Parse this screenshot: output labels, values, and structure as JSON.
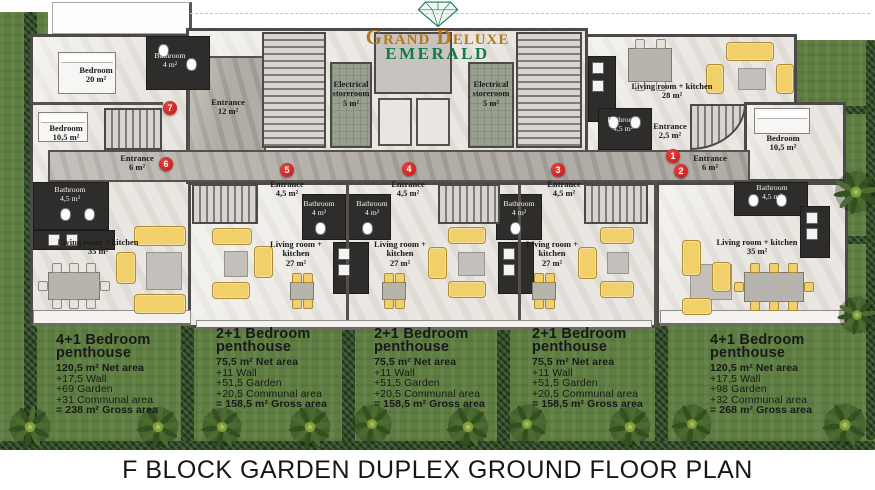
{
  "logo": {
    "brand": "Grand Deluxe",
    "sub": "EMERALD",
    "brand_color": "#b5781d",
    "sub_color": "#157a46",
    "diamond_icon_color": "#1c7c4e"
  },
  "plan_title": "F BLOCK GARDEN DUPLEX GROUND FLOOR PLAN",
  "colors": {
    "grass": "#5e7e41",
    "hedge": "#2b4621",
    "marker": "#c11717",
    "furniture": "#f1d06c",
    "walls": "#4c4a48"
  },
  "markers": [
    {
      "n": "1",
      "x": 673,
      "y": 156
    },
    {
      "n": "2",
      "x": 681,
      "y": 171
    },
    {
      "n": "3",
      "x": 558,
      "y": 170
    },
    {
      "n": "4",
      "x": 409,
      "y": 169
    },
    {
      "n": "5",
      "x": 287,
      "y": 170
    },
    {
      "n": "6",
      "x": 166,
      "y": 164
    },
    {
      "n": "7",
      "x": 170,
      "y": 108
    }
  ],
  "room_labels": [
    {
      "lines": [
        "Bedroom",
        "20 m²"
      ],
      "x": 96,
      "y": 66,
      "dark": false
    },
    {
      "lines": [
        "Bathroom",
        "4 m²"
      ],
      "x": 170,
      "y": 52,
      "dark": true
    },
    {
      "lines": [
        "Bedroom",
        "10,5 m²"
      ],
      "x": 66,
      "y": 124,
      "dark": false
    },
    {
      "lines": [
        "Entrance",
        "6 m²"
      ],
      "x": 137,
      "y": 154,
      "dark": false
    },
    {
      "lines": [
        "Entrance",
        "12 m²"
      ],
      "x": 228,
      "y": 98,
      "dark": false
    },
    {
      "lines": [
        "Electrical",
        "storeroom",
        "5 m²"
      ],
      "x": 351,
      "y": 80,
      "dark": false
    },
    {
      "lines": [
        "Electrical",
        "storeroom",
        "5 m²"
      ],
      "x": 491,
      "y": 80,
      "dark": false
    },
    {
      "lines": [
        "Living room +  kitchen",
        "28 m²"
      ],
      "x": 672,
      "y": 82,
      "dark": false
    },
    {
      "lines": [
        "Bathroom",
        "4,5 m²"
      ],
      "x": 623,
      "y": 116,
      "dark": true
    },
    {
      "lines": [
        "Entrance",
        "2,5 m²"
      ],
      "x": 670,
      "y": 122,
      "dark": false
    },
    {
      "lines": [
        "Entrance",
        "6 m²"
      ],
      "x": 710,
      "y": 154,
      "dark": false
    },
    {
      "lines": [
        "Bedroom",
        "10,5 m²"
      ],
      "x": 783,
      "y": 134,
      "dark": false
    },
    {
      "lines": [
        "Bathroom",
        "4,5 m²"
      ],
      "x": 70,
      "y": 186,
      "dark": true
    },
    {
      "lines": [
        "Living room +  kitchen",
        "35 m²"
      ],
      "x": 98,
      "y": 238,
      "dark": false
    },
    {
      "lines": [
        "Entrance",
        "4,5 m²"
      ],
      "x": 287,
      "y": 180,
      "dark": false
    },
    {
      "lines": [
        "Bathroom",
        "4 m²"
      ],
      "x": 319,
      "y": 200,
      "dark": true
    },
    {
      "lines": [
        "Bathroom",
        "4 m²"
      ],
      "x": 372,
      "y": 200,
      "dark": true
    },
    {
      "lines": [
        "Living room +",
        "kitchen",
        "27 m²"
      ],
      "x": 296,
      "y": 240,
      "dark": false
    },
    {
      "lines": [
        "Entrance",
        "4,5 m²"
      ],
      "x": 408,
      "y": 180,
      "dark": false
    },
    {
      "lines": [
        "Living room +",
        "kitchen",
        "27 m²"
      ],
      "x": 400,
      "y": 240,
      "dark": false
    },
    {
      "lines": [
        "Bathroom",
        "4 m²"
      ],
      "x": 519,
      "y": 200,
      "dark": true
    },
    {
      "lines": [
        "Entrance",
        "4,5 m²"
      ],
      "x": 564,
      "y": 180,
      "dark": false
    },
    {
      "lines": [
        "Living room +",
        "kitchen",
        "27 m²"
      ],
      "x": 552,
      "y": 240,
      "dark": false
    },
    {
      "lines": [
        "Bathroom",
        "4,5 m²"
      ],
      "x": 772,
      "y": 184,
      "dark": true
    },
    {
      "lines": [
        "Living room +  kitchen",
        "35 m²"
      ],
      "x": 757,
      "y": 238,
      "dark": false
    }
  ],
  "unit_summaries": [
    {
      "title": "4+1 Bedroom penthouse",
      "x": 56,
      "y": 334,
      "lines": [
        "120,5 m² Net area",
        "+17,5 Wall",
        "+69 Garden",
        "+31 Communal area",
        "= 238 m² Gross area"
      ]
    },
    {
      "title": "2+1 Bedroom penthouse",
      "x": 216,
      "y": 328,
      "lines": [
        "75,5 m² Net area",
        "+11 Wall",
        "+51,5 Garden",
        "+20,5 Communal area",
        "= 158,5 m² Gross area"
      ]
    },
    {
      "title": "2+1 Bedroom penthouse",
      "x": 374,
      "y": 328,
      "lines": [
        "75,5 m² Net area",
        "+11 Wall",
        "+51,5 Garden",
        "+20,5 Communal area",
        "= 158,5 m² Gross area"
      ]
    },
    {
      "title": "2+1 Bedroom penthouse",
      "x": 532,
      "y": 328,
      "lines": [
        "75,5 m² Net area",
        "+11 Wall",
        "+51,5 Garden",
        "+20,5 Communal area",
        "= 158,5 m² Gross area"
      ]
    },
    {
      "title": "4+1 Bedroom penthouse",
      "x": 710,
      "y": 334,
      "lines": [
        "120,5 m² Net area",
        "+17,5 Wall",
        "+98 Garden",
        "+32 Communal area",
        "= 268 m² Gross area"
      ]
    }
  ]
}
